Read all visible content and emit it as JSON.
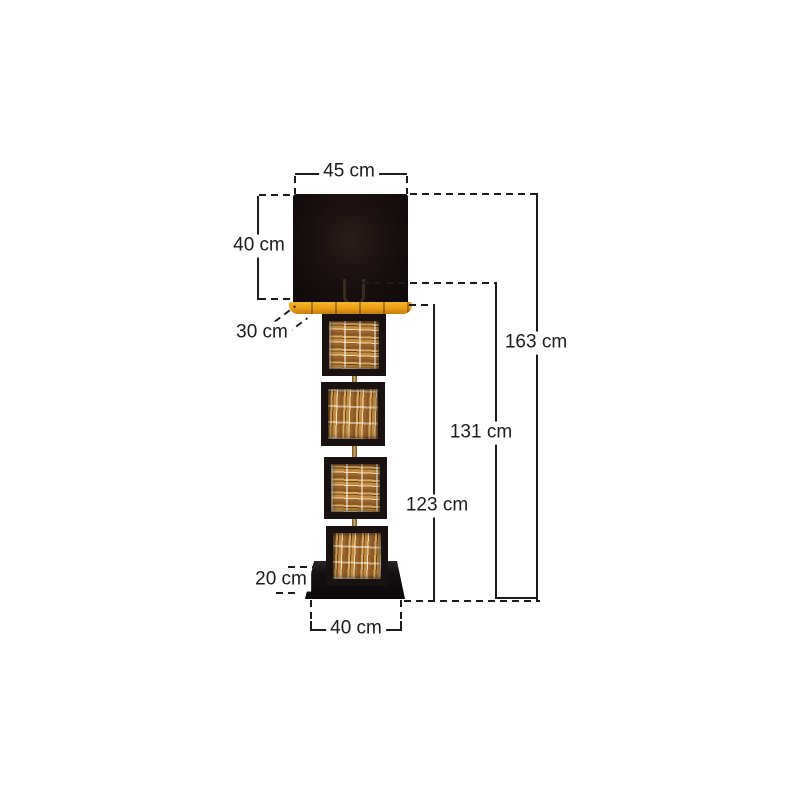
{
  "diagram": {
    "type": "product-dimension-diagram",
    "subject": "floor-lamp-with-black-shade-and-driftwood-panels",
    "unit": "cm",
    "labels": {
      "shade_top_width": "45 cm",
      "shade_height": "40 cm",
      "shade_depth": "30 cm",
      "total_height": "163 cm",
      "height_to_socket": "131 cm",
      "height_to_shade_bottom": "123 cm",
      "base_height": "20 cm",
      "base_width": "40 cm"
    },
    "colors": {
      "background": "#ffffff",
      "dimension_line": "#1c1c1c",
      "shade_black": "#180f0e",
      "rim_gold": "#e89c14",
      "stem_brass": "#cfa95c",
      "wood_light": "#d9ab62",
      "wood_dark": "#6e4218",
      "base_black": "#151011"
    }
  }
}
